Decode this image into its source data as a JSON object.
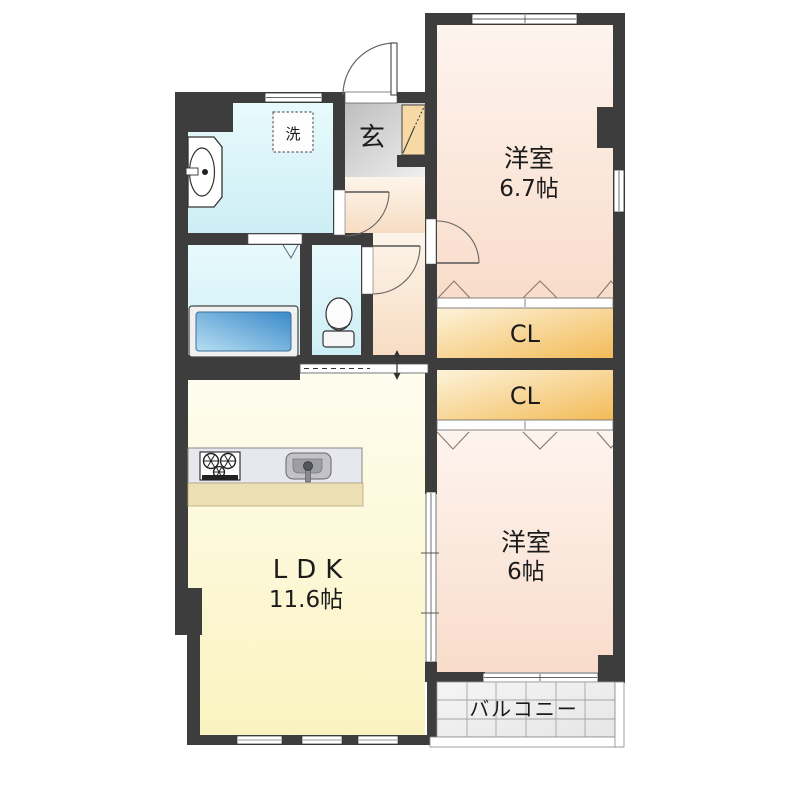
{
  "floorplan": {
    "type": "apartment-floor-plan",
    "rooms": {
      "western1": {
        "name": "洋室",
        "size": "6.7帖"
      },
      "western2": {
        "name": "洋室",
        "size": "6帖"
      },
      "ldk": {
        "name": "LDK",
        "size": "11.6帖"
      }
    },
    "labels": {
      "closet1": "CL",
      "closet2": "CL",
      "balcony": "バルコニー",
      "entrance": "玄",
      "laundry": "洗"
    },
    "colors": {
      "wall": "#3d3d3d",
      "room_pink": "#f9dccb",
      "closet_orange": "#f3bb58",
      "ldk_yellow": "#faf3c0",
      "wet_area_cyan": "#cdeef5",
      "entrance_gray": "#c2c2c2",
      "hallway_peach": "#f7dcc2",
      "bathtub_blue": "#3f8fcb",
      "shoebox_tan": "#f6d9a4",
      "balcony_tile": "#ededed"
    }
  }
}
